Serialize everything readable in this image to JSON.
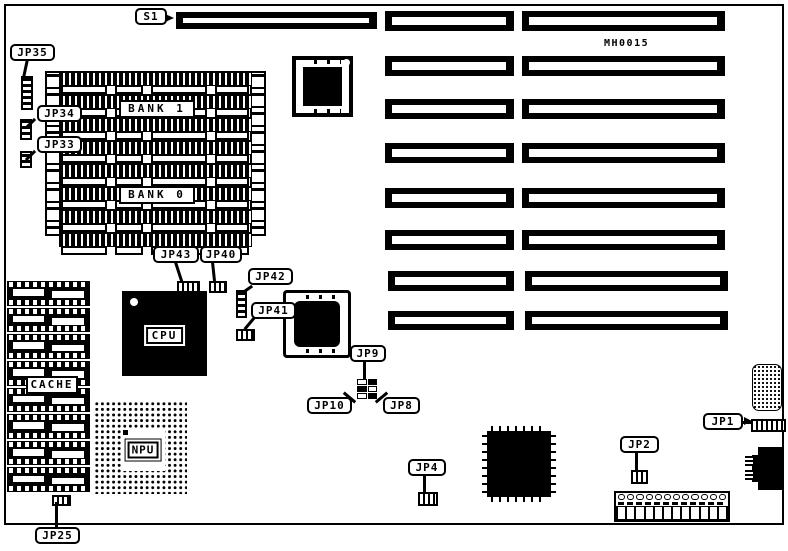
{
  "board": {
    "part_number": "MH0015"
  },
  "callouts": {
    "s1": "S1",
    "jp35": "JP35",
    "jp34": "JP34",
    "jp33": "JP33",
    "jp43": "JP43",
    "jp40": "JP40",
    "jp42": "JP42",
    "jp41": "JP41",
    "jp9": "JP9",
    "jp10": "JP10",
    "jp8": "JP8",
    "jp25": "JP25",
    "jp4": "JP4",
    "jp2": "JP2",
    "jp1": "JP1"
  },
  "components": {
    "cpu": "CPU",
    "npu": "NPU",
    "cache": "CACHE",
    "bank1": "BANK 1",
    "bank0": "BANK 0"
  },
  "colors": {
    "ink": "#000000",
    "background": "#ffffff"
  }
}
